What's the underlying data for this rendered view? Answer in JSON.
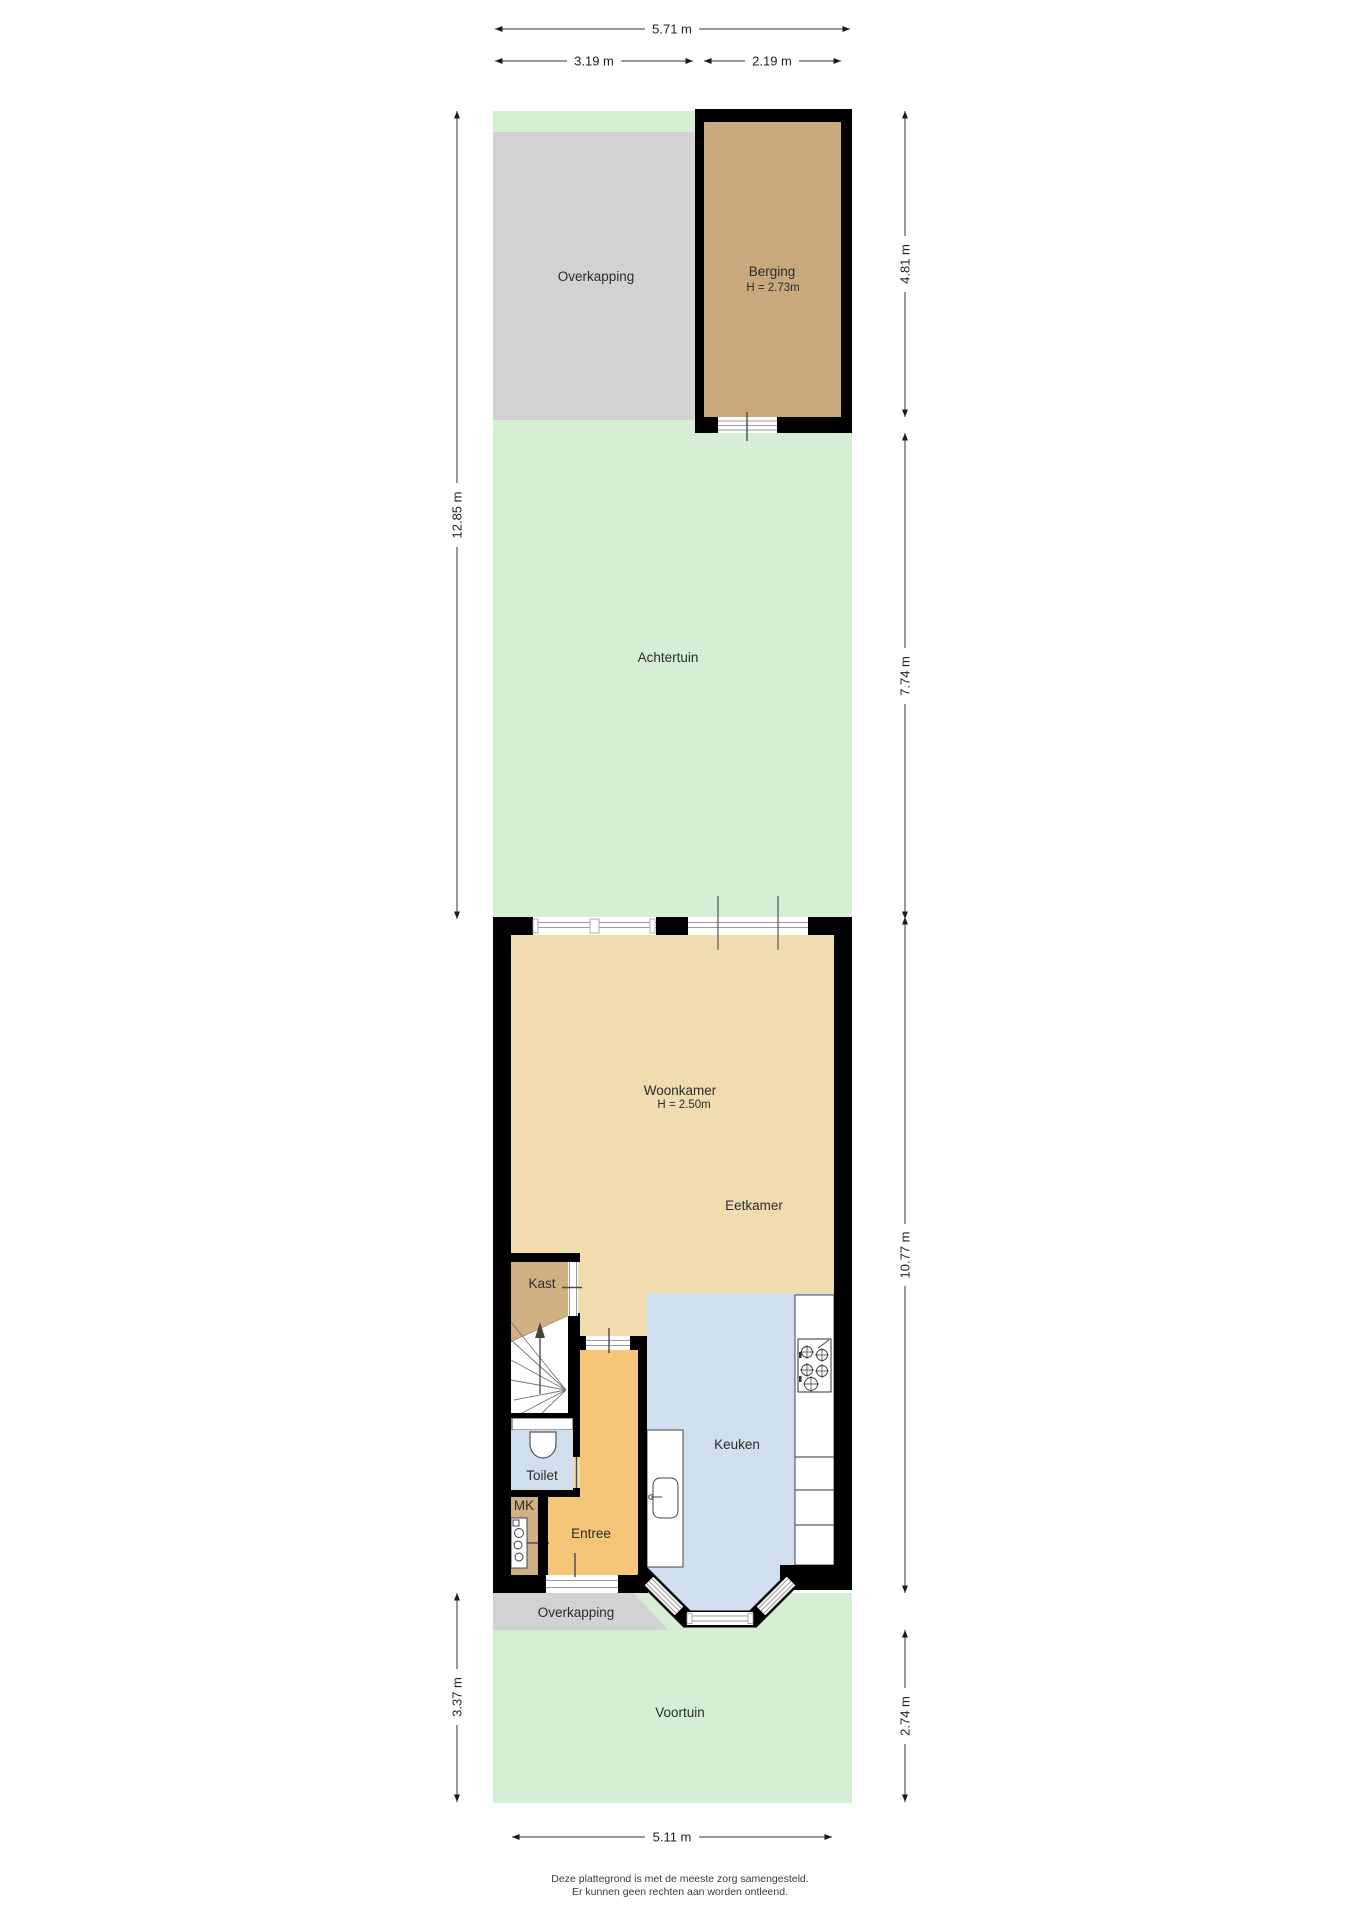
{
  "rooms": {
    "overkapping_back": {
      "label": "Overkapping"
    },
    "berging": {
      "label": "Berging",
      "height": "H = 2.73m"
    },
    "achtertuin": {
      "label": "Achtertuin"
    },
    "woonkamer": {
      "label": "Woonkamer",
      "height": "H = 2.50m"
    },
    "eetkamer": {
      "label": "Eetkamer"
    },
    "kast": {
      "label": "Kast"
    },
    "toilet": {
      "label": "Toilet"
    },
    "mk": {
      "label": "MK"
    },
    "entree": {
      "label": "Entree"
    },
    "keuken": {
      "label": "Keuken"
    },
    "overkapping_front": {
      "label": "Overkapping"
    },
    "voortuin": {
      "label": "Voortuin"
    }
  },
  "dimensions": {
    "top_total": "5.71 m",
    "top_left": "3.19 m",
    "top_right": "2.19 m",
    "left_upper": "12.85 m",
    "left_lower": "3.37 m",
    "right_1": "4.81 m",
    "right_2": "7.74 m",
    "right_3": "10.77 m",
    "right_4": "2.74 m",
    "bottom": "5.11 m"
  },
  "footer": {
    "line1": "Deze plattegrond is met de meeste zorg samengesteld.",
    "line2": "Er kunnen geen rechten aan worden ontleend."
  },
  "colors": {
    "garden": "#d5eed4",
    "overkapping": "#d2d2d2",
    "berging": "#c9a87e",
    "closet": "#d0b083",
    "living": "#f0dcae",
    "hall": "#f5c678",
    "kitchen": "#cfdfee",
    "wall": "#000000",
    "white": "#ffffff"
  }
}
